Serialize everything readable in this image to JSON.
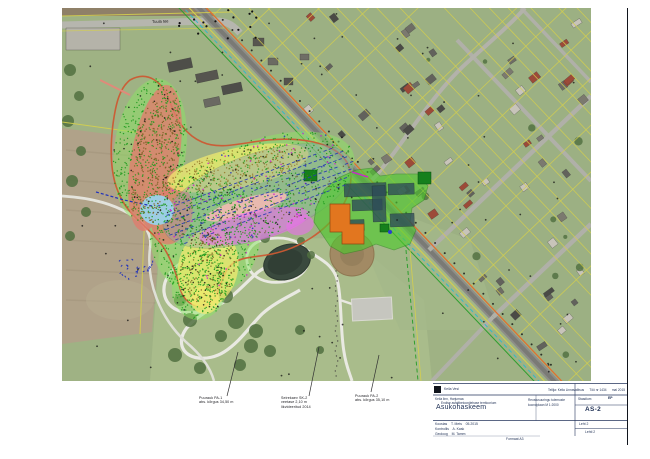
{
  "map": {
    "road_label": "Tuula tee",
    "annotations": [
      {
        "lines": [
          "Puurauk PA-1",
          "abs. kõrgus 34,50 m"
        ]
      },
      {
        "lines": [
          "Seirekaev SK-2",
          "veetase 2,10 m",
          "likvideeritud 2014"
        ]
      },
      {
        "lines": [
          "Puurauk PA-2",
          "abs. kõrgus 35,10 m"
        ]
      }
    ]
  },
  "title_block": {
    "logo_text": "Keila Vesi",
    "header_info": "Tellija: Keila Linnavalitsus      Töö nr 1434      mai 2015",
    "project_line_1": "Keila linn, Harjumaa",
    "project_line_2": "Endise asfaltbetoonitehase territoorium",
    "title_main": "Asukohaskeem",
    "mid_line_1": "Reostusuuringu tulemuste",
    "mid_line_2": "koondplaan  M 1:2000",
    "stage_label": "Staadium",
    "stage_value": "EP",
    "drawing_no": "AS-2",
    "footer_line_1": "Koostas    T. Mets    05.2015",
    "footer_line_2": "Kontrollis    A. Kask",
    "footer_line_3": "Geoloog    M. Tamm",
    "sheet_label": "Leht 2",
    "sheets_label": "Lehti 2",
    "format_note": "Formaat A3"
  },
  "legend_colors": {
    "survey_area": "#8ce464",
    "zone_red": "#e07d6e",
    "zone_yellow": "#f2ea6e",
    "zone_grey": "#8fa4ae",
    "zone_magenta": "#e673e6",
    "zone_pink": "#f2b9b2",
    "zone_cyan": "#96d5f0",
    "boundary_orange": "#cc5a33",
    "planned_green": "#4ecb2d",
    "building_orange": "#e2761f",
    "building_teal": "#2d4b58",
    "points_green": "#1e9a1e",
    "points_blue": "#2a3cb0",
    "points_magenta": "#cc22cc",
    "cadastral_yellow": "#d4cf4e"
  }
}
